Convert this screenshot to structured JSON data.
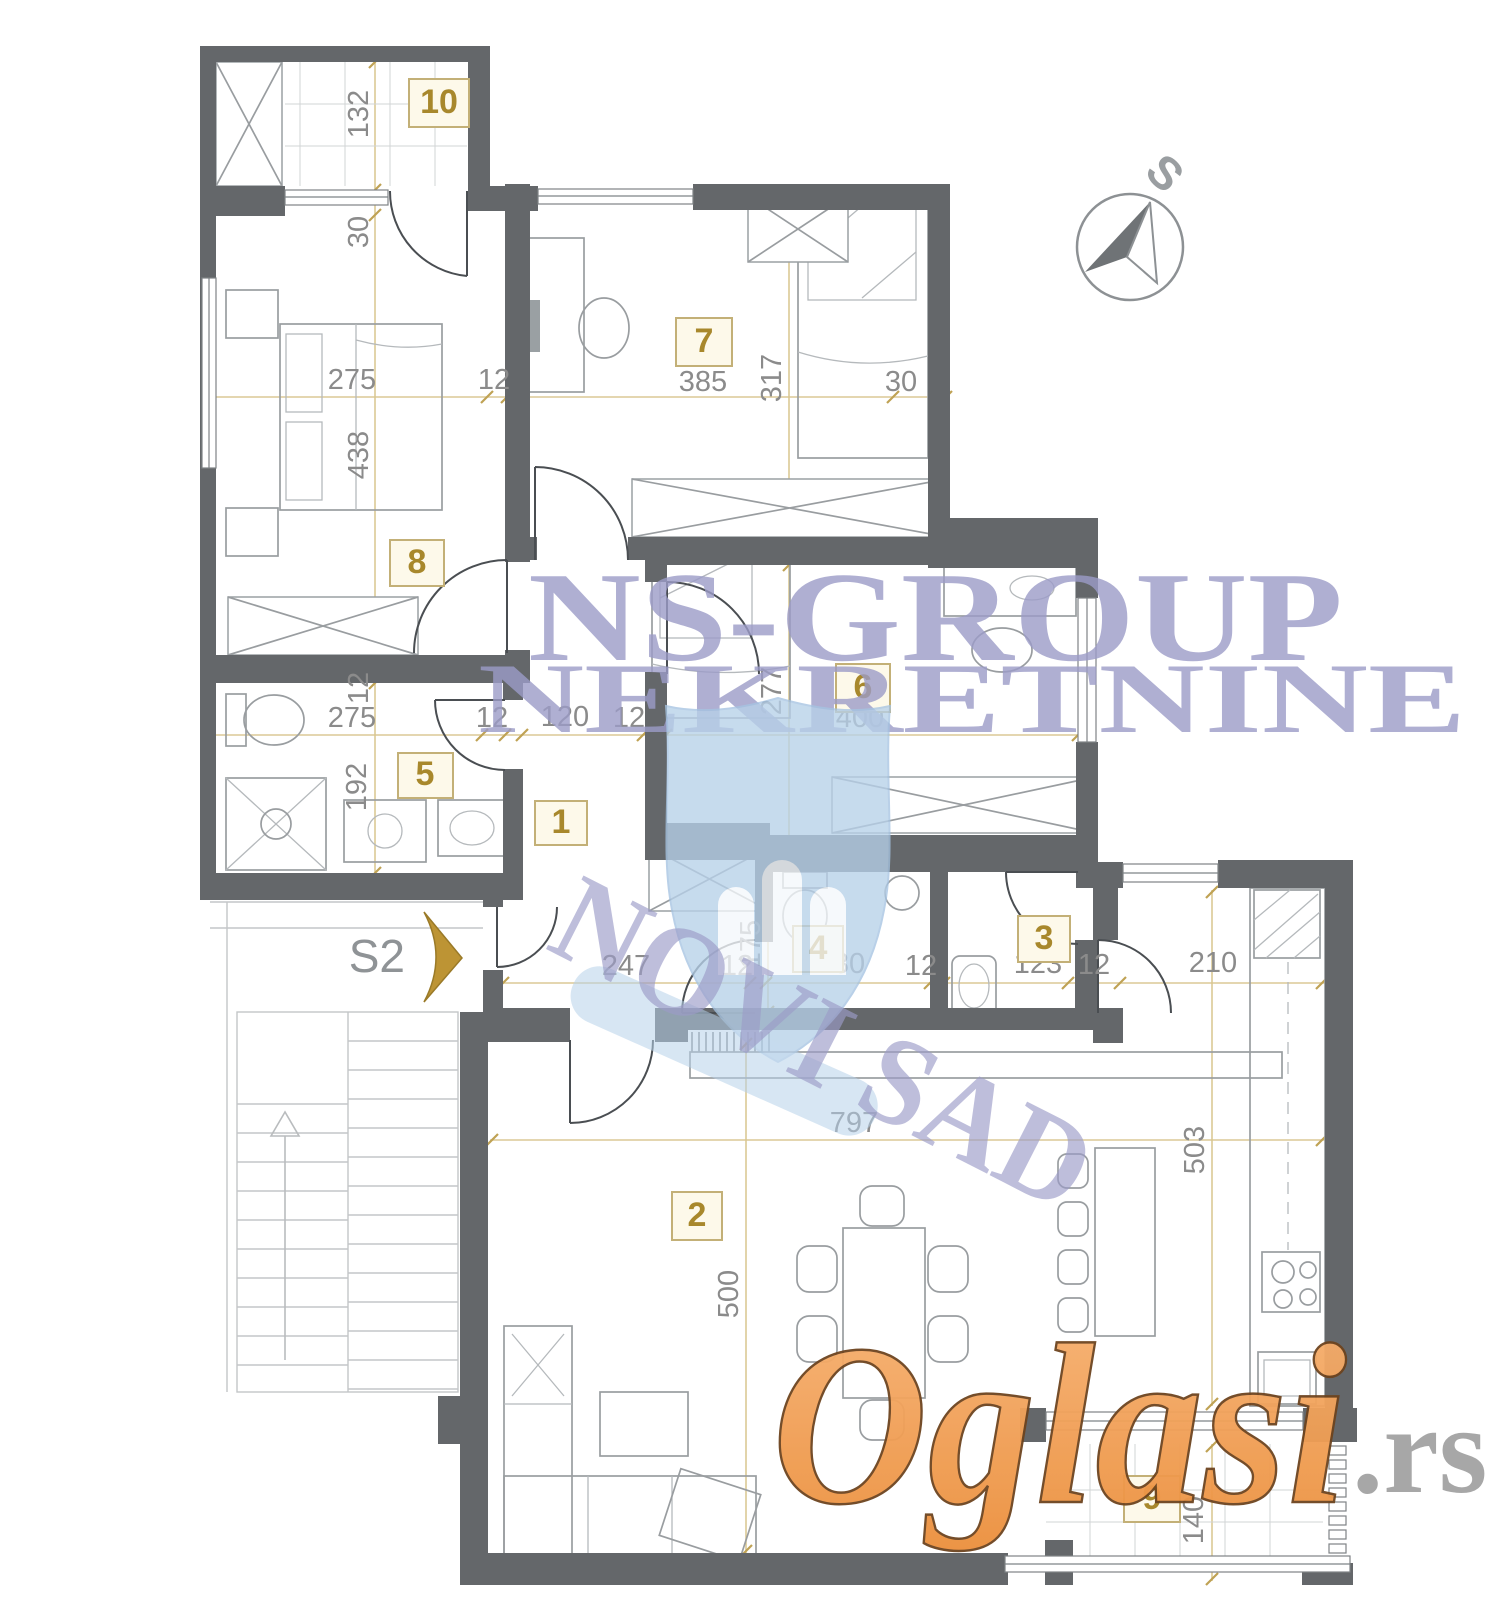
{
  "watermark": {
    "line1": "NS-GROUP",
    "line2": "NEKRETNINE",
    "city": "NOVI SAD",
    "brand": "Oglasi",
    "brand_tld": ".rs"
  },
  "compass": {
    "south_label": "S"
  },
  "stairwell": {
    "label": "S2"
  },
  "rooms": {
    "n1": "1",
    "n2": "2",
    "n3": "3",
    "n4": "4",
    "n5": "5",
    "n6": "6",
    "n7": "7",
    "n8": "8",
    "n9": "9",
    "n10": "10"
  },
  "dims": {
    "v132": "132",
    "v30a": "30",
    "h275a": "275",
    "h12a": "12",
    "h385": "385",
    "v317": "317",
    "h30b": "30",
    "v438": "438",
    "v12b": "12",
    "h275b": "275",
    "v192": "192",
    "h12c": "12",
    "h120": "120",
    "h12d": "12",
    "v277": "277",
    "h400": "400",
    "h247": "247",
    "h12e": "12",
    "v175": "175",
    "h180": "180",
    "h12f": "12",
    "h123": "123",
    "h12g": "12",
    "h210": "210",
    "h797": "797",
    "v500": "500",
    "v503": "503",
    "v140": "140"
  },
  "colors": {
    "wall": "#64676a",
    "dimension_line": "#d9c68f",
    "room_number": "#a8882c",
    "watermark_lavender": "#9c9cc8",
    "watermark_shield": "#b7d1e9",
    "brand_orange": "#f09d4f"
  }
}
